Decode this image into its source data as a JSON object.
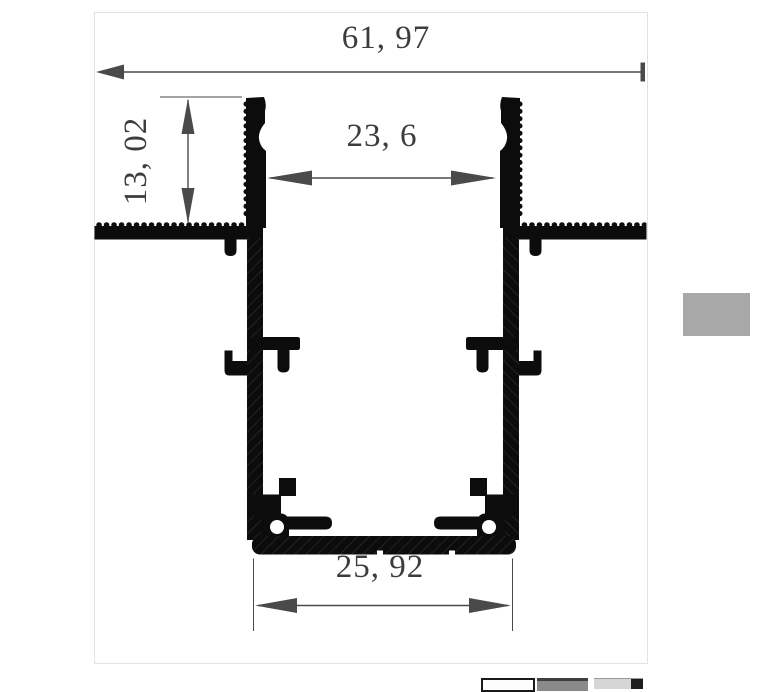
{
  "canvas": {
    "background": "#ffffff",
    "border_color": "#e2e2e2"
  },
  "drawing": {
    "profile_color": "#0c0c0c",
    "hatch_color": "#2e2e2e",
    "dimension_line_color": "#4a4a4a",
    "dimension_text_color": "#3c3c3c",
    "dimensions": [
      {
        "id": "overall-width",
        "value": "61, 97",
        "orientation": "horizontal"
      },
      {
        "id": "recess-depth",
        "value": "13, 02",
        "orientation": "vertical"
      },
      {
        "id": "inner-width",
        "value": "23, 6",
        "orientation": "horizontal"
      },
      {
        "id": "base-width",
        "value": "25, 92",
        "orientation": "horizontal"
      }
    ]
  },
  "side_panel": {
    "color": "#a8a8a8"
  },
  "thumbnails": {
    "count": 3
  }
}
